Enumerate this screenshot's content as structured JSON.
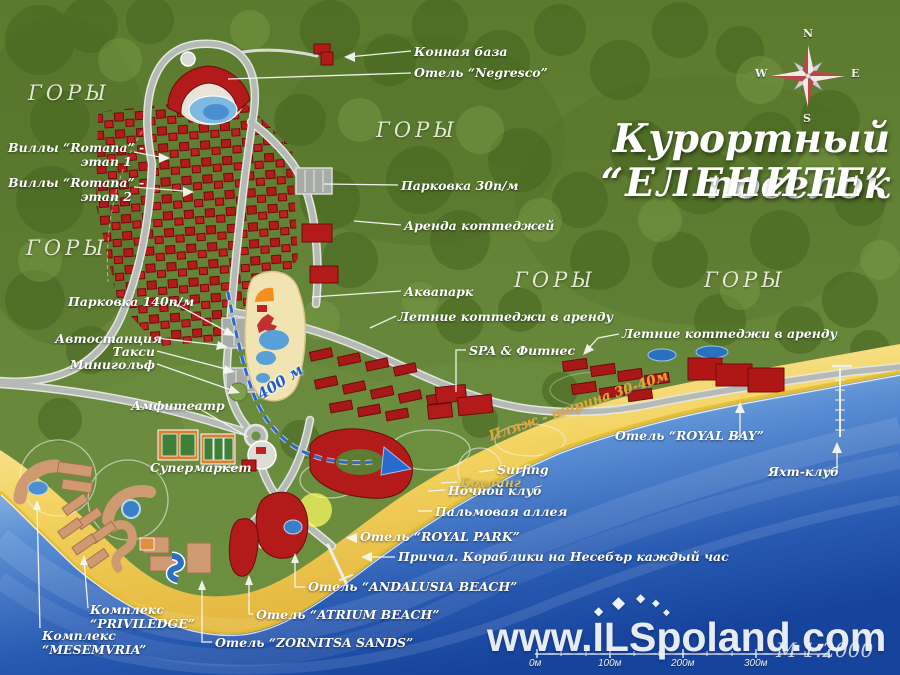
{
  "title": {
    "line1": "Курортный поселок",
    "line2": "“ЕЛЕНИТЕ”"
  },
  "region_labels": [
    {
      "text": "ГОРЫ"
    },
    {
      "text": "ГОРЫ"
    },
    {
      "text": "ГОРЫ"
    },
    {
      "text": "ГОРЫ"
    },
    {
      "text": "ГОРЫ"
    }
  ],
  "callouts": {
    "konnaya_baza": {
      "text": "Конная база"
    },
    "negresco": {
      "text": "Отель “Negresco”"
    },
    "romana1": {
      "line1": "Виллы “Romana” -",
      "line2": "этап 1"
    },
    "romana2": {
      "line1": "Виллы “Romana” -",
      "line2": "этап 2"
    },
    "parkovka30": {
      "text": "Парковка 30п/м"
    },
    "arenda_kottedzhey": {
      "text": "Аренда коттеджей"
    },
    "akvapark": {
      "text": "Аквапарк"
    },
    "letnie1": {
      "text": "Летние коттеджи в аренду"
    },
    "parkovka140": {
      "text": "Парковка 140п/м"
    },
    "avtostantsiya": {
      "text": "Автостанция"
    },
    "taksi": {
      "text": "Такси"
    },
    "minigolf": {
      "text": "Минигольф"
    },
    "amfiteatr": {
      "text": "Амфитеатр"
    },
    "supermarket": {
      "text": "Супермаркет"
    },
    "spa": {
      "text": "SPA & Фитнес"
    },
    "letnie2": {
      "text": "Летние коттеджи в аренду"
    },
    "royal_bay": {
      "text": "Отель “ROYAL BAY”"
    },
    "yaht_klub": {
      "text": "Яхт-клуб"
    },
    "surfing": {
      "text": "Surfing"
    },
    "bouling": {
      "text": "Боулинг"
    },
    "nochnoy_klub": {
      "text": "Ночной клуб"
    },
    "palmovaya": {
      "text": "Пальмовая аллея"
    },
    "royal_park": {
      "text": "Отель “ROYAL PARK”"
    },
    "prichal": {
      "text": "Причал. Кораблики на Несебър каждый час"
    },
    "andalusia": {
      "text": "Отель “ANDALUSIA BEACH”"
    },
    "atrium": {
      "text": "Отель “ATRIUM BEACH”"
    },
    "zornitsa": {
      "text": "Отель “ZORNITSA SANDS”"
    },
    "priviledge": {
      "line1": "Комплекс",
      "line2": "“PRIVILEDGE”"
    },
    "mesemvria": {
      "line1": "Комплекс",
      "line2": "“MESEMVRIA”"
    }
  },
  "annotations": {
    "route_distance": "400 м",
    "beach_width": "Пляж - ширина 30-40м"
  },
  "compass": {
    "n": "N",
    "e": "E",
    "s": "S",
    "w": "W"
  },
  "watermark": {
    "text": "www.ILSpoland.com"
  },
  "scale": {
    "ticks": [
      "0м",
      "100м",
      "200м",
      "300м"
    ],
    "note": "М 1:2000"
  },
  "colors": {
    "sea_deep": "#16439c",
    "sand": "#f3d360",
    "forest": "#63833a",
    "building_red": "#b31a1a",
    "building_tan": "#cf9a72",
    "route_blue": "#2a6ad0",
    "accent_gold": "#e8a52e"
  }
}
